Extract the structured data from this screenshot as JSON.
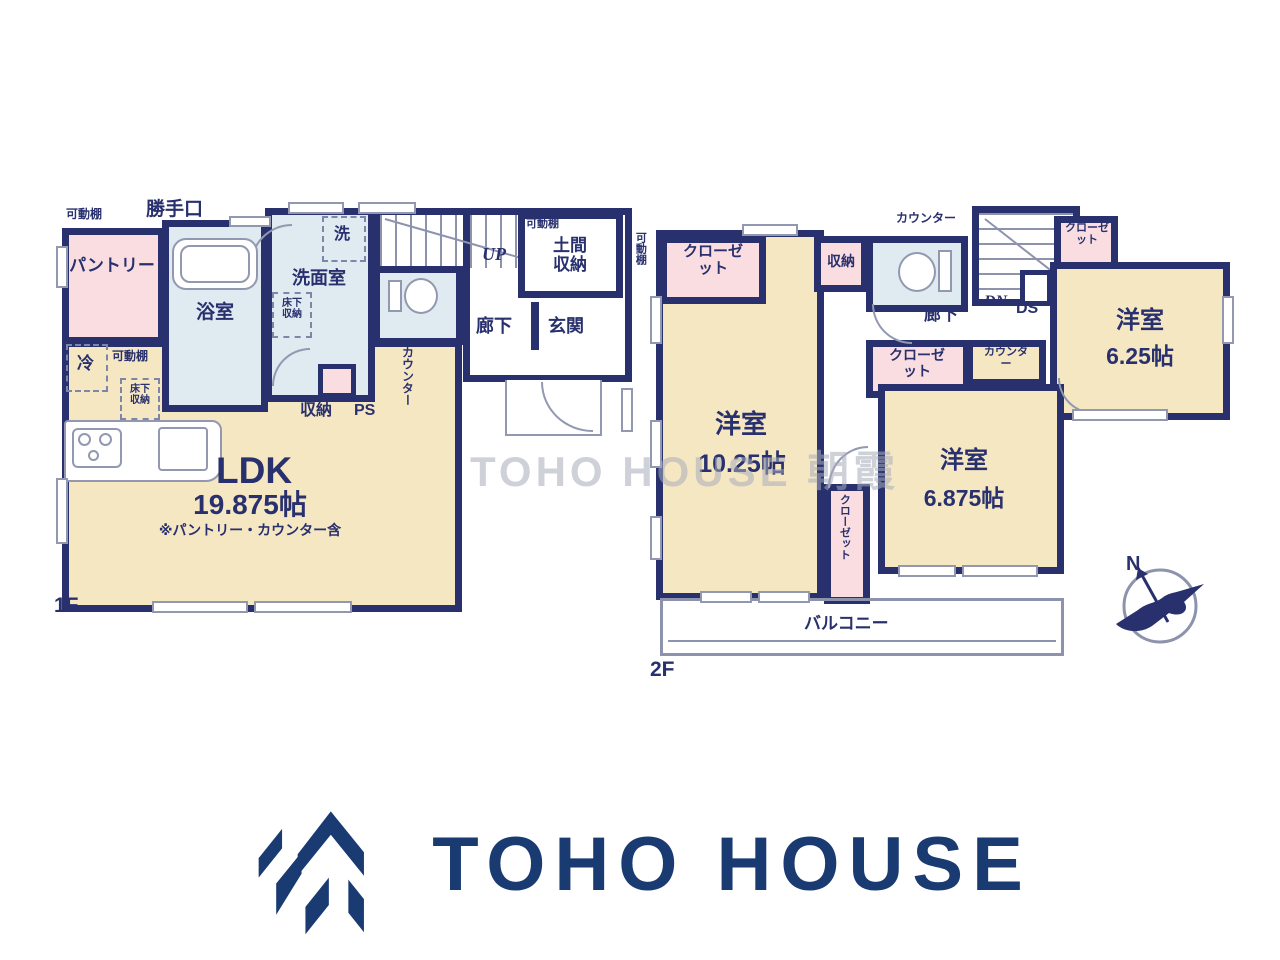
{
  "watermark": {
    "text": "TOHO HOUSE 朝霞"
  },
  "compass": {
    "north": "N"
  },
  "logo": {
    "brand": "TOHO HOUSE"
  },
  "floor1": {
    "label": "1F",
    "shelf_top": "可動棚",
    "back_door": "勝手口",
    "pantry": "パントリー",
    "bath": "浴室",
    "washroom": "洗面室",
    "washer": "洗",
    "underfloor_wash": "床下収納",
    "stairs_up": "UP",
    "doma_shelf": "可動棚",
    "doma_storage": "土間収納",
    "shelf_right": "可動棚",
    "hall": "廊下",
    "entrance": "玄関",
    "fridge": "冷",
    "shelf_mid": "可動棚",
    "underfloor_ldk": "床下収納",
    "storage": "収納",
    "ps": "PS",
    "counter": "カウンター",
    "ldk": "LDK",
    "ldk_size": "19.875帖",
    "ldk_note": "※パントリー・カウンター含"
  },
  "floor2": {
    "label": "2F",
    "closet_nw": "クローゼット",
    "storage": "収納",
    "counter_top": "カウンター",
    "stairs_down": "DN",
    "duct": "DS",
    "closet_ne": "クローゼット",
    "room_east": "洋室",
    "room_east_size": "6.25帖",
    "hall": "廊下",
    "closet_mid": "クローゼット",
    "counter_mid": "カウンター",
    "room_main": "洋室",
    "room_main_size": "10.25帖",
    "room_south": "洋室",
    "room_south_size": "6.875帖",
    "closet_vert": "クローゼット",
    "balcony": "バルコニー"
  }
}
